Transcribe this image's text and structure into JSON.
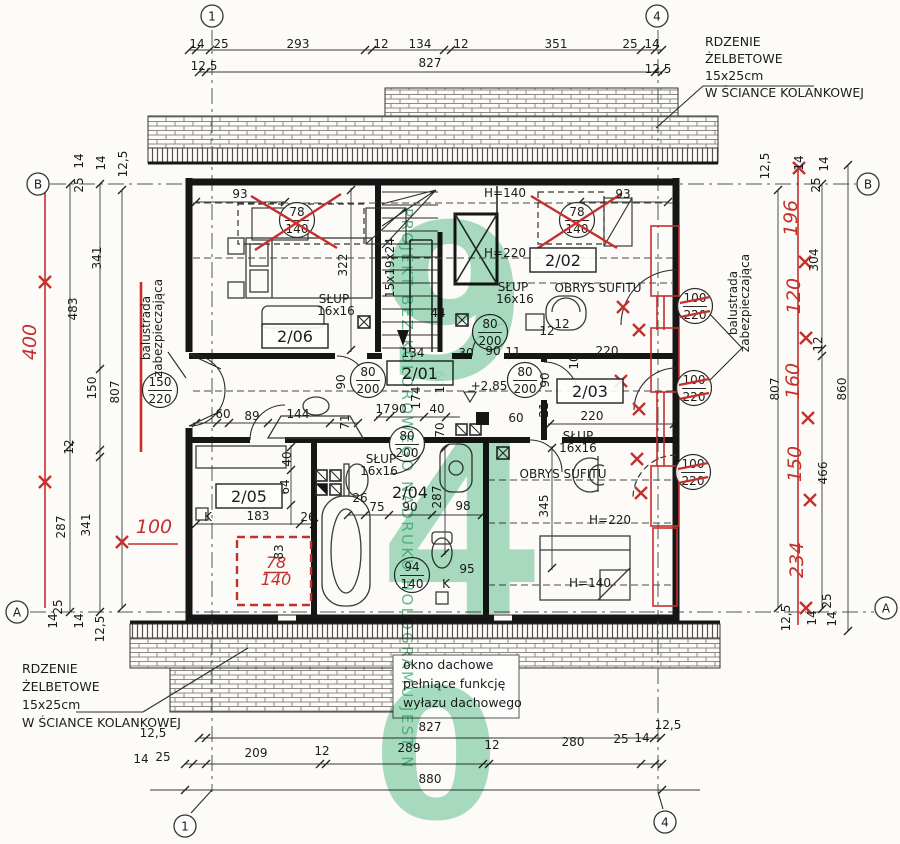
{
  "colors": {
    "ink": "#1c1c1c",
    "red": "#c4302e",
    "green": "#53bb88",
    "paper": "#fcfbf7"
  },
  "grid_markers": [
    {
      "t": "1",
      "x": 212,
      "y": 16
    },
    {
      "t": "4",
      "x": 657,
      "y": 16
    },
    {
      "t": "B",
      "x": 38,
      "y": 184
    },
    {
      "t": "B",
      "x": 868,
      "y": 184
    },
    {
      "t": "A",
      "x": 17,
      "y": 612
    },
    {
      "t": "A",
      "x": 886,
      "y": 608
    },
    {
      "t": "1",
      "x": 185,
      "y": 826
    },
    {
      "t": "4",
      "x": 665,
      "y": 822
    }
  ],
  "rooms": [
    {
      "label": "2/01",
      "x": 420,
      "y": 378,
      "boxed": true
    },
    {
      "label": "2/02",
      "x": 563,
      "y": 265,
      "boxed": true
    },
    {
      "label": "2/03",
      "x": 590,
      "y": 396,
      "boxed": true
    },
    {
      "label": "2/04",
      "x": 410,
      "y": 497,
      "boxed": false
    },
    {
      "label": "2/05",
      "x": 249,
      "y": 501,
      "boxed": true
    },
    {
      "label": "2/06",
      "x": 295,
      "y": 341,
      "boxed": true
    }
  ],
  "dim_labels": {
    "top": [
      {
        "t": "14",
        "x": 197,
        "y": 48
      },
      {
        "t": "25",
        "x": 221,
        "y": 48
      },
      {
        "t": "293",
        "x": 298,
        "y": 48
      },
      {
        "t": "12",
        "x": 381,
        "y": 48
      },
      {
        "t": "134",
        "x": 420,
        "y": 48
      },
      {
        "t": "12",
        "x": 461,
        "y": 48
      },
      {
        "t": "351",
        "x": 556,
        "y": 48
      },
      {
        "t": "25",
        "x": 630,
        "y": 48
      },
      {
        "t": "14",
        "x": 652,
        "y": 48
      },
      {
        "t": "12,5",
        "x": 204,
        "y": 70
      },
      {
        "t": "827",
        "x": 430,
        "y": 67
      },
      {
        "t": "12,5",
        "x": 658,
        "y": 73
      }
    ],
    "bottom": [
      {
        "t": "12,5",
        "x": 153,
        "y": 737
      },
      {
        "t": "827",
        "x": 430,
        "y": 731
      },
      {
        "t": "12,5",
        "x": 668,
        "y": 729
      },
      {
        "t": "14",
        "x": 141,
        "y": 763
      },
      {
        "t": "25",
        "x": 163,
        "y": 761
      },
      {
        "t": "209",
        "x": 256,
        "y": 757
      },
      {
        "t": "12",
        "x": 322,
        "y": 755
      },
      {
        "t": "289",
        "x": 409,
        "y": 752
      },
      {
        "t": "12",
        "x": 492,
        "y": 749
      },
      {
        "t": "280",
        "x": 573,
        "y": 746
      },
      {
        "t": "25",
        "x": 621,
        "y": 743
      },
      {
        "t": "14",
        "x": 642,
        "y": 742
      },
      {
        "t": "880",
        "x": 430,
        "y": 783
      }
    ],
    "left": [
      {
        "t": "14",
        "x": 83,
        "y": 161,
        "r": -90
      },
      {
        "t": "25",
        "x": 83,
        "y": 185,
        "r": -90
      },
      {
        "t": "14",
        "x": 105,
        "y": 163,
        "r": -90
      },
      {
        "t": "12,5",
        "x": 127,
        "y": 164,
        "r": -90
      },
      {
        "t": "341",
        "x": 101,
        "y": 258,
        "r": -90
      },
      {
        "t": "483",
        "x": 77,
        "y": 309,
        "r": -90
      },
      {
        "t": "150",
        "x": 96,
        "y": 388,
        "r": -90
      },
      {
        "t": "807",
        "x": 119,
        "y": 392,
        "r": -90
      },
      {
        "t": "12",
        "x": 73,
        "y": 447,
        "r": -90
      },
      {
        "t": "287",
        "x": 65,
        "y": 527,
        "r": -90
      },
      {
        "t": "341",
        "x": 90,
        "y": 525,
        "r": -90
      },
      {
        "t": "25",
        "x": 62,
        "y": 607,
        "r": -90
      },
      {
        "t": "14",
        "x": 57,
        "y": 621,
        "r": -90
      },
      {
        "t": "14",
        "x": 83,
        "y": 621,
        "r": -90
      },
      {
        "t": "12,5",
        "x": 104,
        "y": 629,
        "r": -90
      },
      {
        "t": "400",
        "x": 36,
        "y": 342,
        "r": -90,
        "c": "red"
      },
      {
        "t": "100",
        "x": 154,
        "y": 533,
        "c": "red",
        "s": 17
      }
    ],
    "right": [
      {
        "t": "12,5",
        "x": 769,
        "y": 166,
        "r": -90
      },
      {
        "t": "14",
        "x": 803,
        "y": 163,
        "r": -90
      },
      {
        "t": "25",
        "x": 820,
        "y": 185,
        "r": -90
      },
      {
        "t": "14",
        "x": 828,
        "y": 164,
        "r": -90
      },
      {
        "t": "196",
        "x": 797,
        "y": 218,
        "r": -90,
        "c": "red"
      },
      {
        "t": "304",
        "x": 818,
        "y": 260,
        "r": -90
      },
      {
        "t": "120",
        "x": 800,
        "y": 296,
        "r": -90,
        "c": "red"
      },
      {
        "t": "12",
        "x": 822,
        "y": 344,
        "r": -90
      },
      {
        "t": "160",
        "x": 799,
        "y": 381,
        "r": -90,
        "c": "red"
      },
      {
        "t": "807",
        "x": 779,
        "y": 389,
        "r": -90
      },
      {
        "t": "860",
        "x": 846,
        "y": 389,
        "r": -90
      },
      {
        "t": "150",
        "x": 801,
        "y": 464,
        "r": -90,
        "c": "red"
      },
      {
        "t": "466",
        "x": 827,
        "y": 473,
        "r": -90
      },
      {
        "t": "234",
        "x": 803,
        "y": 560,
        "r": -90,
        "c": "red"
      },
      {
        "t": "12,5",
        "x": 790,
        "y": 618,
        "r": -90
      },
      {
        "t": "14",
        "x": 816,
        "y": 618,
        "r": -90
      },
      {
        "t": "25",
        "x": 831,
        "y": 601,
        "r": -90
      },
      {
        "t": "14",
        "x": 836,
        "y": 619,
        "r": -90
      }
    ],
    "interior": [
      {
        "t": "93",
        "x": 240,
        "y": 198
      },
      {
        "t": "93",
        "x": 623,
        "y": 198
      },
      {
        "t": "322",
        "x": 347,
        "y": 265,
        "r": -90
      },
      {
        "t": "44",
        "x": 438,
        "y": 317
      },
      {
        "t": "134",
        "x": 413,
        "y": 357
      },
      {
        "t": "30",
        "x": 466,
        "y": 357
      },
      {
        "t": "90",
        "x": 493,
        "y": 355
      },
      {
        "t": "11",
        "x": 513,
        "y": 356
      },
      {
        "t": "109",
        "x": 444,
        "y": 382,
        "r": -90
      },
      {
        "t": "174",
        "x": 420,
        "y": 398,
        "r": -90
      },
      {
        "t": "17",
        "x": 383,
        "y": 413
      },
      {
        "t": "90",
        "x": 399,
        "y": 413
      },
      {
        "t": "40",
        "x": 437,
        "y": 413
      },
      {
        "t": "70",
        "x": 444,
        "y": 430,
        "r": -90
      },
      {
        "t": "90",
        "x": 345,
        "y": 382,
        "r": -90
      },
      {
        "t": "71",
        "x": 349,
        "y": 422,
        "r": -90
      },
      {
        "t": "12",
        "x": 547,
        "y": 335
      },
      {
        "t": "60",
        "x": 516,
        "y": 422
      },
      {
        "t": "21",
        "x": 548,
        "y": 410,
        "r": -90
      },
      {
        "t": "90",
        "x": 549,
        "y": 380,
        "r": -90
      },
      {
        "t": "220",
        "x": 607,
        "y": 355
      },
      {
        "t": "220",
        "x": 592,
        "y": 420
      },
      {
        "t": "10",
        "x": 578,
        "y": 362,
        "r": -90
      },
      {
        "t": "345",
        "x": 548,
        "y": 506,
        "r": -90
      },
      {
        "t": "287",
        "x": 441,
        "y": 497,
        "r": -90
      },
      {
        "t": "26",
        "x": 360,
        "y": 502
      },
      {
        "t": "75",
        "x": 377,
        "y": 511
      },
      {
        "t": "90",
        "x": 410,
        "y": 511
      },
      {
        "t": "98",
        "x": 463,
        "y": 510
      },
      {
        "t": "95",
        "x": 467,
        "y": 573
      },
      {
        "t": "60",
        "x": 223,
        "y": 418
      },
      {
        "t": "89",
        "x": 252,
        "y": 420
      },
      {
        "t": "144",
        "x": 298,
        "y": 418
      },
      {
        "t": "183",
        "x": 258,
        "y": 520
      },
      {
        "t": "26",
        "x": 308,
        "y": 521
      },
      {
        "t": "40",
        "x": 291,
        "y": 459,
        "r": -90
      },
      {
        "t": "64",
        "x": 289,
        "y": 487,
        "r": -90
      },
      {
        "t": "83",
        "x": 283,
        "y": 552,
        "r": -90
      },
      {
        "t": "K",
        "x": 208,
        "y": 521,
        "s": 10
      },
      {
        "t": "K",
        "x": 446,
        "y": 588,
        "s": 10
      },
      {
        "t": "12",
        "x": 562,
        "y": 328
      },
      {
        "t": "15x19x24",
        "x": 394,
        "y": 268,
        "r": -90,
        "s": 11
      },
      {
        "t": "+2,85",
        "x": 489,
        "y": 390,
        "s": 15
      }
    ]
  },
  "height_labels": [
    {
      "t": "H=140",
      "x": 505,
      "y": 197
    },
    {
      "t": "H=220",
      "x": 505,
      "y": 257
    },
    {
      "t": "H=220",
      "x": 610,
      "y": 524
    },
    {
      "t": "H=140",
      "x": 590,
      "y": 587
    }
  ],
  "column_labels": [
    {
      "t": "SŁUP",
      "x": 334,
      "y": 303
    },
    {
      "t": "16x16",
      "x": 336,
      "y": 315
    },
    {
      "t": "SŁUP",
      "x": 513,
      "y": 291
    },
    {
      "t": "16x16",
      "x": 515,
      "y": 303
    },
    {
      "t": "SŁUP",
      "x": 381,
      "y": 463
    },
    {
      "t": "16x16",
      "x": 379,
      "y": 475
    },
    {
      "t": "SŁUP",
      "x": 578,
      "y": 440
    },
    {
      "t": "16x16",
      "x": 578,
      "y": 452
    }
  ],
  "ceiling_labels": [
    {
      "t": "OBRYS SUFITU",
      "x": 598,
      "y": 292
    },
    {
      "t": "OBRYS SUFITU",
      "x": 563,
      "y": 478
    }
  ],
  "tags": [
    {
      "top": "78",
      "bottom": "140",
      "x": 297,
      "y": 220,
      "cross": true
    },
    {
      "top": "78",
      "bottom": "140",
      "x": 577,
      "y": 220,
      "cross": true
    },
    {
      "top": "150",
      "bottom": "220",
      "x": 160,
      "y": 390
    },
    {
      "top": "80",
      "bottom": "200",
      "x": 368,
      "y": 380
    },
    {
      "top": "80",
      "bottom": "200",
      "x": 525,
      "y": 380
    },
    {
      "top": "80",
      "bottom": "200",
      "x": 407,
      "y": 444
    },
    {
      "top": "80",
      "bottom": "200",
      "x": 490,
      "y": 332
    },
    {
      "top": "94",
      "bottom": "140",
      "x": 412,
      "y": 575
    },
    {
      "top": "100",
      "bottom": "220",
      "x": 695,
      "y": 306,
      "struck": true
    },
    {
      "top": "100",
      "bottom": "220",
      "x": 694,
      "y": 388,
      "struck": true
    },
    {
      "top": "100",
      "bottom": "220",
      "x": 693,
      "y": 472,
      "struck": true
    },
    {
      "top": "78",
      "bottom": "140",
      "x": 276,
      "y": 572,
      "color": "red",
      "circle": false
    }
  ],
  "annotations": {
    "rebar-note-top-right": {
      "x": 705,
      "y": 46,
      "lh": 17,
      "lines": [
        "RDZENIE",
        "ŻELBETOWE",
        "15x25cm",
        "W ŚCIANCE KOLANKOWEJ"
      ]
    },
    "rebar-note-bottom-left": {
      "x": 22,
      "y": 673,
      "lh": 18,
      "lines": [
        "RDZENIE",
        "ŻELBETOWE",
        "15x25cm",
        "W ŚCIANCE KOLANKOWEJ"
      ]
    },
    "roof-hatch-note": {
      "x": 403,
      "y": 669,
      "lh": 19,
      "boxed": true,
      "lines": [
        "okno dachowe",
        "pełniące funkcję",
        "wyłazu dachowego"
      ]
    },
    "balustrade-note-left": {
      "x": 150,
      "y": 328,
      "lh": 12,
      "rot": -90,
      "lines": [
        "balustrada",
        "zabezpieczająca"
      ]
    },
    "balustrade-note-right": {
      "x": 737,
      "y": 303,
      "lh": 12,
      "rot": -90,
      "lines": [
        "balustrada",
        "zabezpieczająca"
      ]
    }
  },
  "watermark": {
    "vertical_text": "PROJEKT BEZ KOLOROWEGO NADRUKU HOLOGRAMU JEST N",
    "digits": [
      {
        "t": "9",
        "x": 453,
        "y": 378,
        "s": 215
      },
      {
        "t": "4",
        "x": 462,
        "y": 614,
        "s": 240
      },
      {
        "t": "0",
        "x": 436,
        "y": 818,
        "s": 180
      }
    ]
  }
}
